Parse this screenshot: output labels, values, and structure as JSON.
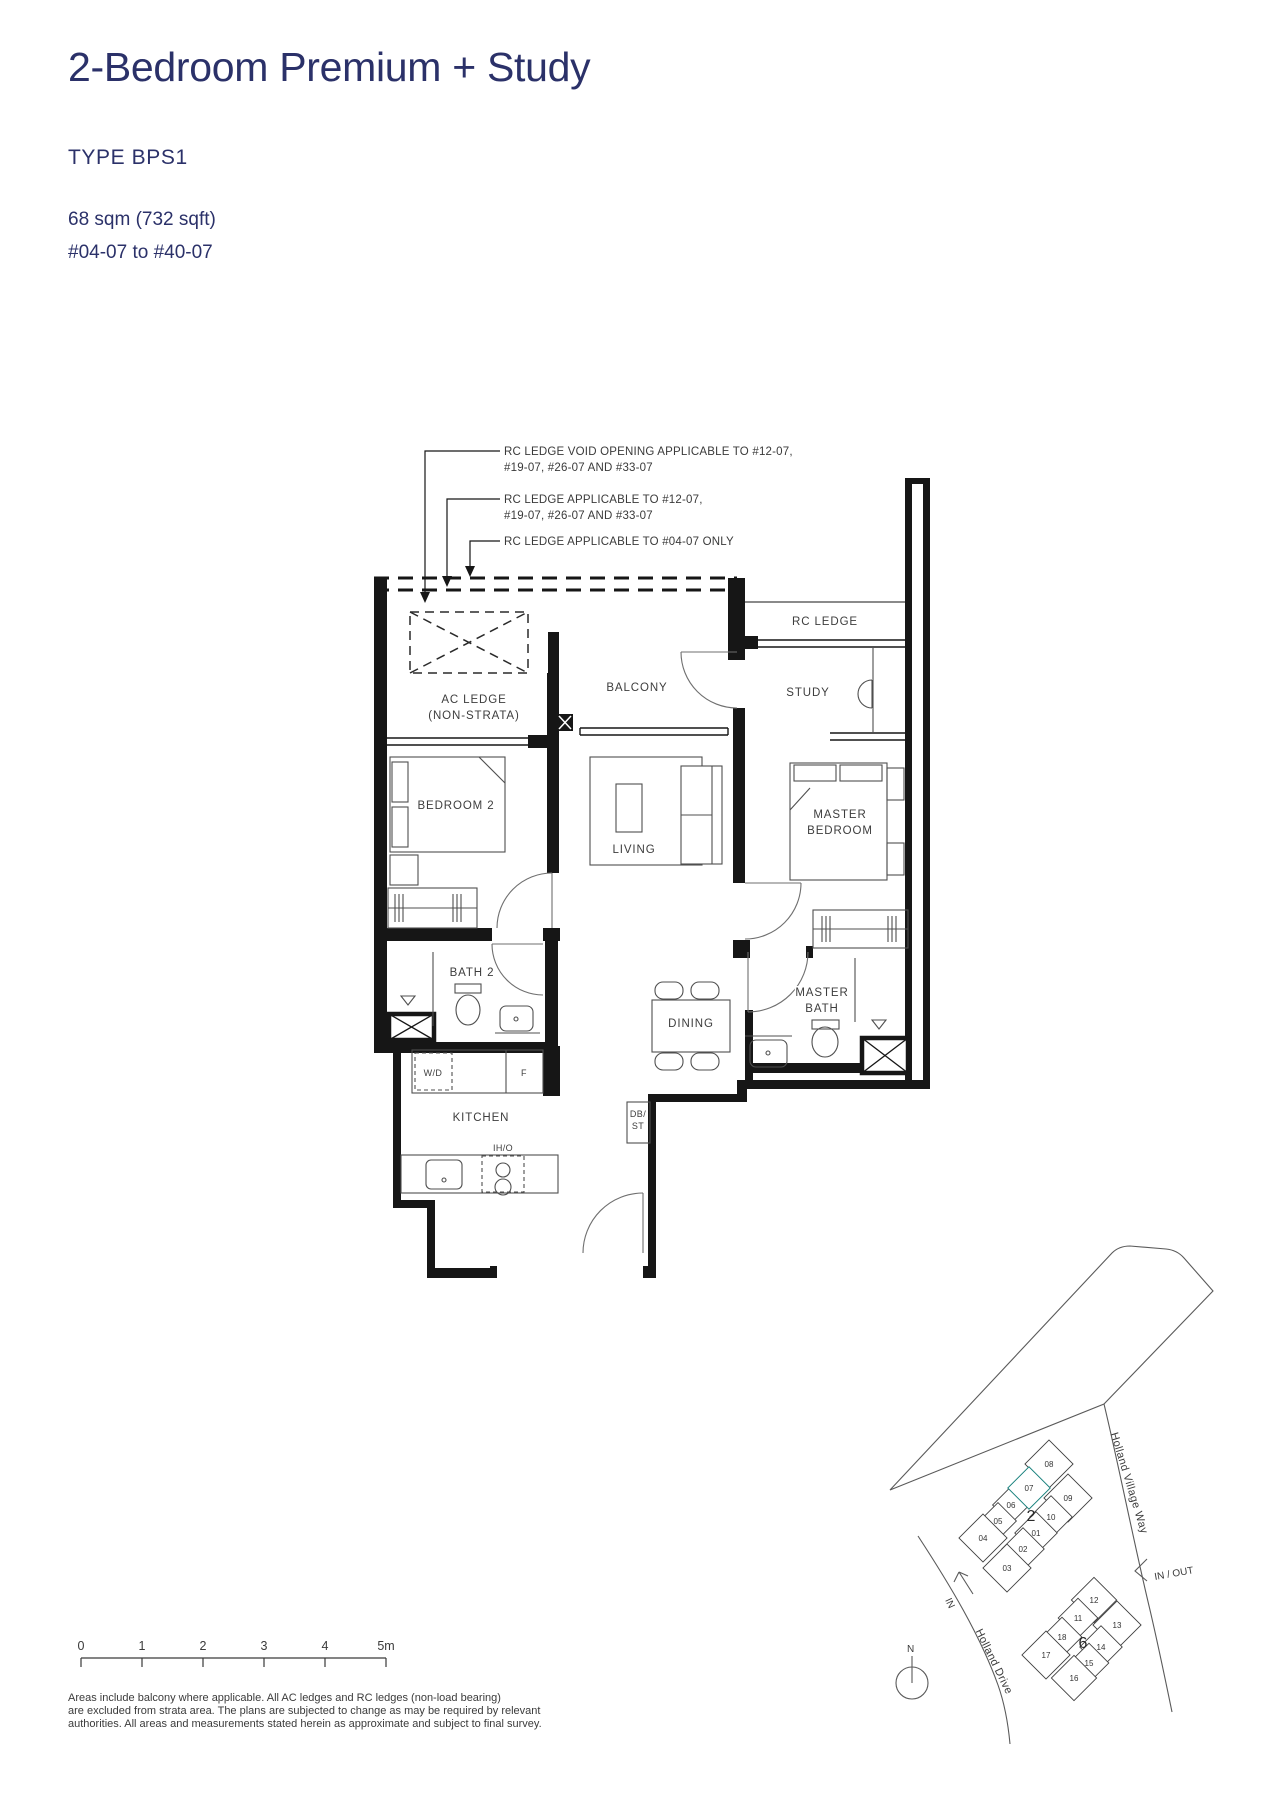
{
  "header": {
    "title": "2-Bedroom Premium + Study",
    "type_label": "TYPE BPS1",
    "area": "68 sqm (732 sqft)",
    "unit_range": "#04-07 to #40-07",
    "accent_color": "#2b3169"
  },
  "annotations": {
    "rc_void_line1": "RC LEDGE VOID OPENING APPLICABLE TO #12-07,",
    "rc_void_line2": "#19-07, #26-07 AND #33-07",
    "rc_ledge_line1": "RC LEDGE APPLICABLE TO #12-07,",
    "rc_ledge_line2": "#19-07, #26-07 AND #33-07",
    "rc_ledge_0407": "RC LEDGE APPLICABLE TO #04-07 ONLY"
  },
  "floorplan": {
    "rooms": {
      "rc_ledge": "RC LEDGE",
      "balcony": "BALCONY",
      "study": "STUDY",
      "ac_ledge_line1": "AC LEDGE",
      "ac_ledge_line2": "(NON-STRATA)",
      "bedroom2": "BEDROOM 2",
      "living": "LIVING",
      "master_line1": "MASTER",
      "master_line2": "BEDROOM",
      "bath2": "BATH 2",
      "dining": "DINING",
      "master_bath_line1": "MASTER",
      "master_bath_line2": "BATH",
      "kitchen": "KITCHEN"
    },
    "fixtures": {
      "washer_dryer": "W/D",
      "fridge": "F",
      "hob": "IH/O",
      "db_line1": "DB/",
      "db_line2": "ST"
    }
  },
  "site_plan": {
    "highlight_color": "#35A8A4",
    "highlighted_unit": "07",
    "roads": {
      "holland_village_way": "Holland Village Way",
      "holland_drive": "Holland Drive"
    },
    "labels": {
      "in_out": "IN / OUT",
      "in": "IN",
      "north": "N"
    },
    "stack2": {
      "label": "2",
      "units": [
        "01",
        "02",
        "03",
        "04",
        "05",
        "06",
        "07",
        "08",
        "09",
        "10"
      ]
    },
    "stack6": {
      "label": "6",
      "units": [
        "11",
        "12",
        "13",
        "14",
        "15",
        "16",
        "17",
        "18"
      ]
    }
  },
  "scale_bar": {
    "ticks": [
      "0",
      "1",
      "2",
      "3",
      "4",
      "5m"
    ]
  },
  "disclaimer": {
    "line1": "Areas include balcony where applicable. All AC ledges and RC ledges (non-load bearing)",
    "line2": "are excluded from strata area. The plans are subjected to change as may be required by relevant",
    "line3": "authorities. All areas and measurements stated herein as approximate and subject to final survey."
  }
}
